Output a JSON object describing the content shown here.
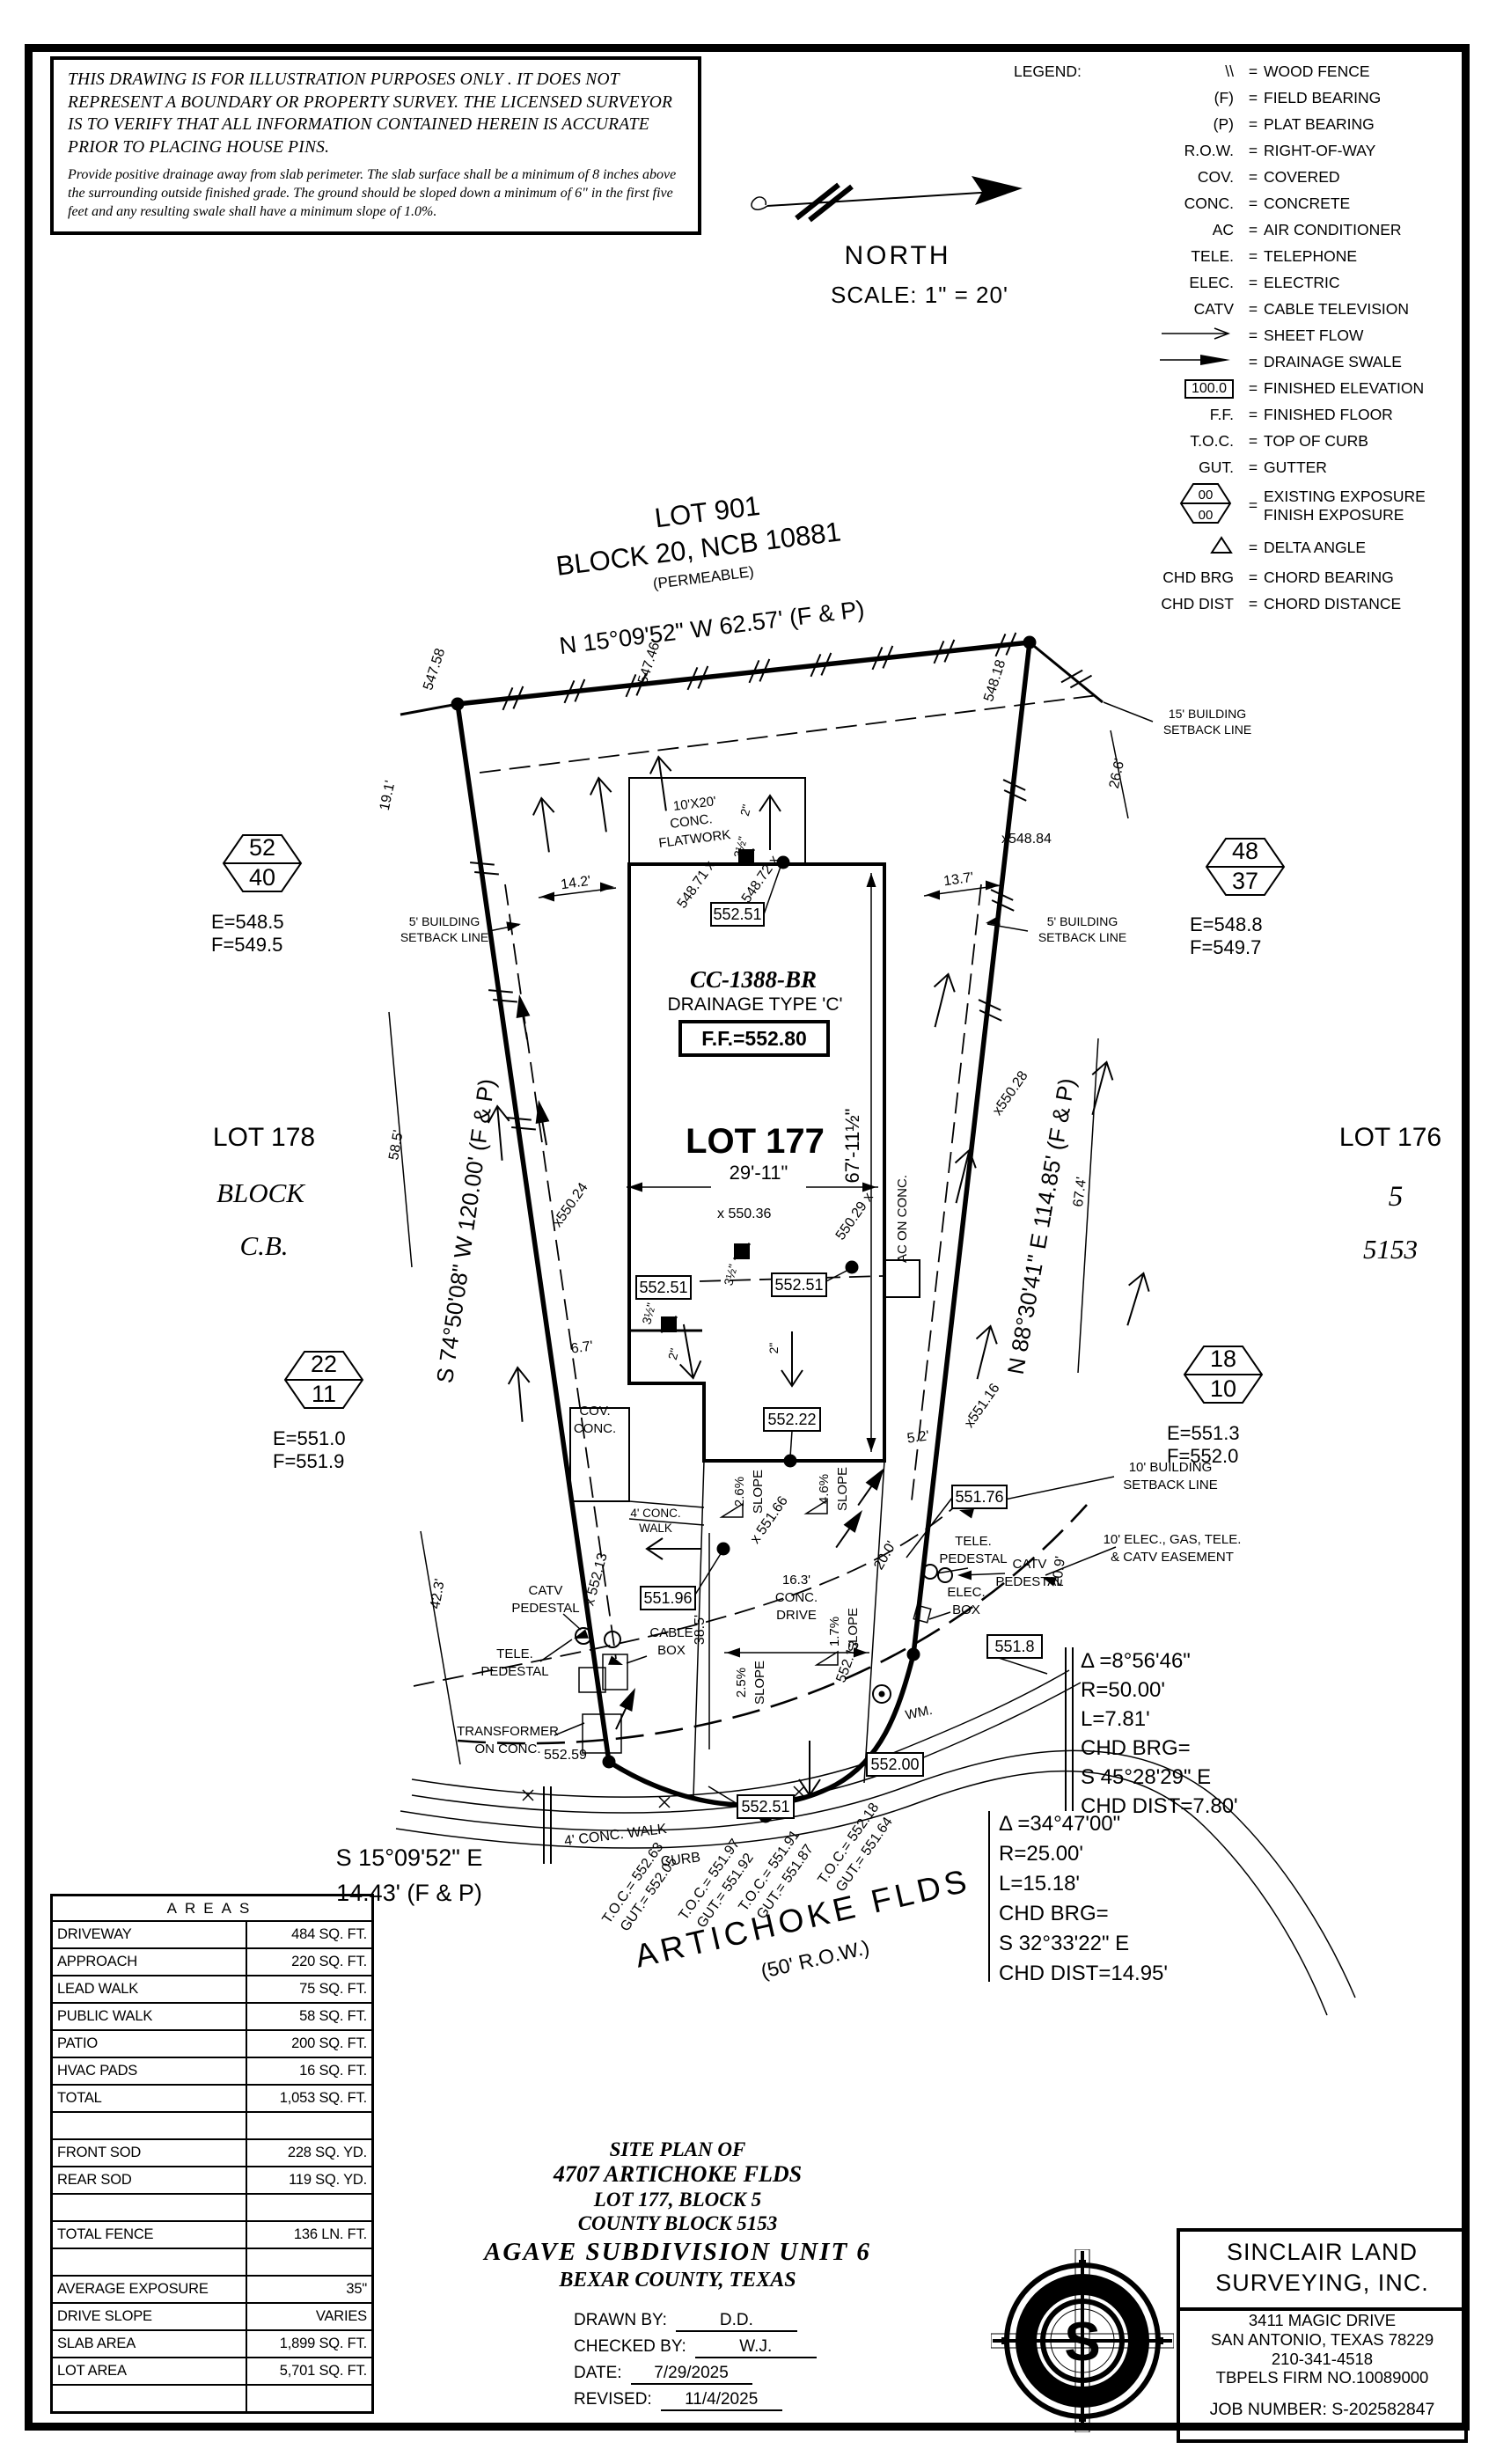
{
  "colors": {
    "ink": "#000000",
    "paper": "#ffffff",
    "logo_orange": "#E87B33"
  },
  "disclaimer": {
    "para1": "THIS DRAWING IS FOR ILLUSTRATION PURPOSES ONLY . IT DOES NOT REPRESENT A BOUNDARY OR PROPERTY SURVEY. THE LICENSED SURVEYOR IS TO VERIFY THAT ALL INFORMATION CONTAINED HEREIN IS ACCURATE PRIOR TO PLACING HOUSE PINS.",
    "para2": "Provide positive drainage away from slab perimeter. The slab surface shall be a minimum of 8 inches above the surrounding outside finished grade. The ground should be sloped down a minimum of 6\" in the first five feet and any resulting swale shall have a minimum slope of 1.0%."
  },
  "north": {
    "label": "NORTH",
    "scale": "SCALE: 1\" = 20'"
  },
  "legend": {
    "title": "LEGEND:",
    "finished_elev_value": "100.0",
    "exposure_top": "00",
    "exposure_bottom": "00",
    "rows": [
      {
        "sym": "\\\\",
        "desc": "WOOD FENCE"
      },
      {
        "sym": "(F)",
        "desc": "FIELD BEARING"
      },
      {
        "sym": "(P)",
        "desc": "PLAT BEARING"
      },
      {
        "sym": "R.O.W.",
        "desc": "RIGHT-OF-WAY"
      },
      {
        "sym": "COV.",
        "desc": "COVERED"
      },
      {
        "sym": "CONC.",
        "desc": "CONCRETE"
      },
      {
        "sym": "AC",
        "desc": "AIR CONDITIONER"
      },
      {
        "sym": "TELE.",
        "desc": "TELEPHONE"
      },
      {
        "sym": "ELEC.",
        "desc": "ELECTRIC"
      },
      {
        "sym": "CATV",
        "desc": "CABLE TELEVISION"
      },
      {
        "sym": "",
        "desc": "SHEET FLOW"
      },
      {
        "sym": "",
        "desc": "DRAINAGE SWALE"
      },
      {
        "sym": "",
        "desc": "FINISHED ELEVATION"
      },
      {
        "sym": "F.F.",
        "desc": "FINISHED FLOOR"
      },
      {
        "sym": "T.O.C.",
        "desc": "TOP OF CURB"
      },
      {
        "sym": "GUT.",
        "desc": "GUTTER"
      },
      {
        "sym": "",
        "desc": "EXISTING EXPOSURE",
        "desc2": "FINISH EXPOSURE"
      },
      {
        "sym": "",
        "desc": "DELTA ANGLE"
      },
      {
        "sym": "CHD BRG",
        "desc": "CHORD BEARING"
      },
      {
        "sym": "CHD DIST",
        "desc": "CHORD DISTANCE"
      }
    ]
  },
  "plan": {
    "lot901_l1": "LOT 901",
    "lot901_l2": "BLOCK 20, NCB 10881",
    "lot901_l3": "(PERMEABLE)",
    "brg_top": "N 15°09'52\" W  62.57'  (F & P)",
    "brg_left": "S 74°50'08\" W  120.00'  (F & P)",
    "brg_right": "N 88°30'41\" E  114.85'  (F & P)",
    "brg_bottom_l1": "S 15°09'52\" E",
    "brg_bottom_l2": "14.43'  (F & P)",
    "sb15_l1": "15' BUILDING",
    "sb15_l2": "SETBACK LINE",
    "sb5_l1": "5' BUILDING",
    "sb5_l2": "SETBACK LINE",
    "sb10_l1": "10' BUILDING",
    "sb10_l2": "SETBACK LINE",
    "ease_l1": "10' ELEC., GAS, TELE.",
    "ease_l2": "& CATV EASEMENT",
    "flat_l1": "10'X20'",
    "flat_l2": "CONC.",
    "flat_l3": "FLATWORK",
    "cc": "CC-1388-BR",
    "drainage_type": "DRAINAGE  TYPE  'C'",
    "ff": "F.F.=552.80",
    "lot177": "LOT 177",
    "lot178_l1": "LOT 178",
    "lot178_l2": "BLOCK",
    "lot178_l3": "C.B.",
    "lot176_l1": "LOT 176",
    "lot176_l2": "5",
    "lot176_l3": "5153",
    "hexTL_t": "52",
    "hexTL_b": "40",
    "hexTL_e": "E=548.5",
    "hexTL_f": "F=549.5",
    "hexTR_t": "48",
    "hexTR_b": "37",
    "hexTR_e": "E=548.8",
    "hexTR_f": "F=549.7",
    "hexML_t": "22",
    "hexML_b": "11",
    "hexML_e": "E=551.0",
    "hexML_f": "F=551.9",
    "hexMR_t": "18",
    "hexMR_b": "10",
    "hexMR_e": "E=551.3",
    "hexMR_f": "F=552.0",
    "d19_1": "19.1'",
    "d26_6": "26.6'",
    "d14_2": "14.2'",
    "d13_7": "13.7'",
    "d58_5": "58.5'",
    "d42_3": "42.3'",
    "d67_4": "67.4'",
    "d20_9": "20.9'",
    "d20_0": "20.0'",
    "d6_7": "6.7'",
    "d5_2": "5.2'",
    "d38_5": "38.5'",
    "d29_11": "29'-11\"",
    "d67_11": "67'-11½\"",
    "d16_3_l1": "16.3'",
    "d16_3_l2": "CONC.",
    "d16_3_l3": "DRIVE",
    "s547_58": "547.58",
    "s547_46": "547.46",
    "s548_18": "548.18",
    "s548_84": "x548.84",
    "s548_71": "548.71 x",
    "s548_72": "548.72 x",
    "s550_36": "x 550.36",
    "s550_29": "550.29 x",
    "s550_24": "x550.24",
    "s550_28": "x550.28",
    "s551_16": "x551.16",
    "s551_66": "x 551.66",
    "s552_13a": "x 552.13",
    "s552_13b": "552.13",
    "s552_59": "552.59",
    "b552_51": "552.51",
    "b552_22": "552.22",
    "b551_96": "551.96",
    "b551_76": "551.76",
    "b551_8": "551.8",
    "b552_00": "552.00",
    "ac": "AC ON CONC.",
    "cov_l1": "COV.",
    "cov_l2": "CONC.",
    "sl26": "2.6%",
    "sl46": "4.6%",
    "sl25": "2.5%",
    "sl17": "1.7%",
    "slope": "SLOPE",
    "walk_l1": "4' CONC.",
    "walk_l2": "WALK",
    "walk_street": "4' CONC. WALK",
    "curb": "CURB",
    "catv_l1": "CATV",
    "catv_l2": "PEDESTAL",
    "tele_l1": "TELE.",
    "tele_l2": "PEDESTAL",
    "cable_l1": "CABLE",
    "cable_l2": "BOX",
    "elec_l1": "ELEC.",
    "elec_l2": "BOX",
    "xfmr_l1": "TRANSFORMER",
    "xfmr_l2": "ON CONC.",
    "wm": "WM.",
    "in2": "2\"",
    "in3": "3½\"",
    "toc1_a": "T.O.C.= 552.63",
    "toc1_b": "GUT.= 552.05",
    "toc2_a": "T.O.C.= 551.97",
    "toc2_b": "GUT.= 551.92",
    "toc3_a": "T.O.C.= 551.91",
    "toc3_b": "GUT.= 551.87",
    "toc4_a": "T.O.C.= 552.18",
    "toc4_b": "GUT.= 551.64",
    "street_l1": "ARTICHOKE  FLDS",
    "street_l2": "(50' R.O.W.)"
  },
  "curve1": {
    "d": "Δ =8°56'46\"",
    "r": "R=50.00'",
    "l": "L=7.81'",
    "cb": "CHD BRG=",
    "cbv": "S 45°28'29\" E",
    "cd": "CHD DIST=7.80'"
  },
  "curve2": {
    "d": "Δ =34°47'00\"",
    "r": "R=25.00'",
    "l": "L=15.18'",
    "cb": "CHD BRG=",
    "cbv": "S 32°33'22\" E",
    "cd": "CHD DIST=14.95'"
  },
  "areas": {
    "title": "AREAS",
    "rows": [
      {
        "label": "DRIVEWAY",
        "value": "484 SQ. FT."
      },
      {
        "label": "APPROACH",
        "value": "220 SQ. FT."
      },
      {
        "label": "LEAD WALK",
        "value": "75 SQ. FT."
      },
      {
        "label": "PUBLIC WALK",
        "value": "58 SQ. FT."
      },
      {
        "label": "PATIO",
        "value": "200 SQ. FT."
      },
      {
        "label": "HVAC PADS",
        "value": "16 SQ. FT."
      },
      {
        "label": "TOTAL",
        "value": "1,053 SQ. FT."
      },
      {
        "label": "",
        "value": ""
      },
      {
        "label": "FRONT SOD",
        "value": "228 SQ. YD."
      },
      {
        "label": "REAR SOD",
        "value": "119 SQ. YD."
      },
      {
        "label": "",
        "value": ""
      },
      {
        "label": "TOTAL FENCE",
        "value": "136 LN. FT."
      },
      {
        "label": "",
        "value": ""
      },
      {
        "label": "AVERAGE EXPOSURE",
        "value": "35\""
      },
      {
        "label": "DRIVE SLOPE",
        "value": "VARIES"
      },
      {
        "label": "SLAB AREA",
        "value": "1,899 SQ. FT."
      },
      {
        "label": "LOT AREA",
        "value": "5,701 SQ. FT."
      },
      {
        "label": "",
        "value": ""
      }
    ]
  },
  "titleblock": {
    "l1": "SITE PLAN OF",
    "l2": "4707 ARTICHOKE FLDS",
    "l3": "LOT 177, BLOCK 5",
    "l4": "COUNTY BLOCK 5153",
    "l5": "AGAVE SUBDIVISION UNIT 6",
    "l6": "BEXAR COUNTY, TEXAS",
    "drawn_label": "DRAWN BY:",
    "drawn": "D.D.",
    "checked_label": "CHECKED BY:",
    "checked": "W.J.",
    "date_label": "DATE:",
    "date": "7/29/2025",
    "revised_label": "REVISED:",
    "revised": "11/4/2025"
  },
  "firm": {
    "name1": "SINCLAIR LAND",
    "name2": "SURVEYING, INC.",
    "addr1": "3411 MAGIC DRIVE",
    "addr2": "SAN ANTONIO, TEXAS 78229",
    "phone": "210-341-4518",
    "firm_no": "TBPELS FIRM NO.10089000",
    "job": "JOB NUMBER:  S-202582847",
    "logo_letter": "S"
  }
}
